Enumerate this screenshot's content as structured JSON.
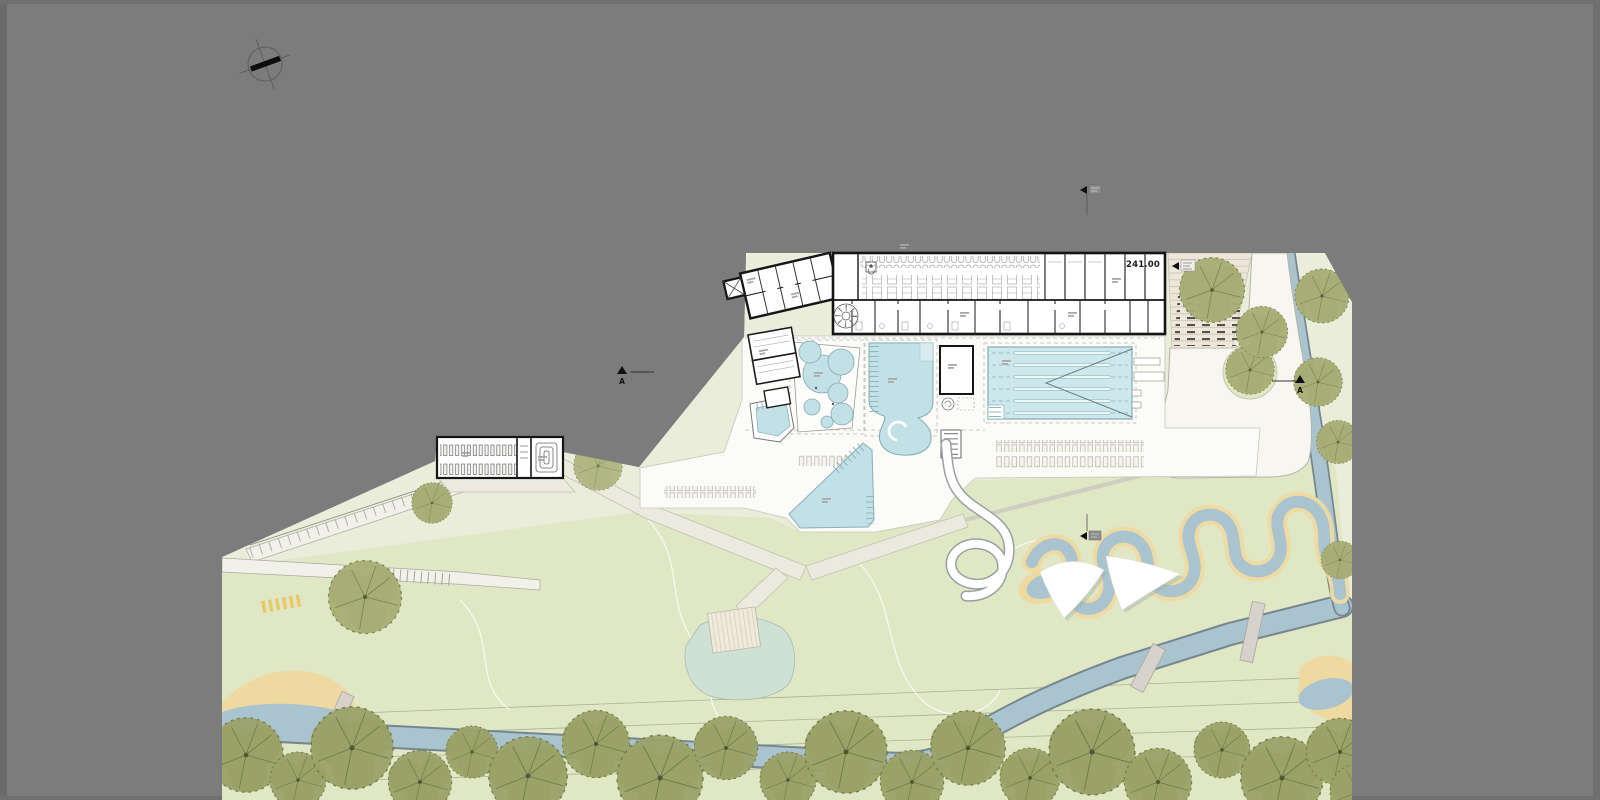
{
  "document": {
    "type": "architectural-site-plan",
    "subject": "Outdoor swimming pool (Freibad) site plan: main bath building floor plan, pools, water slide, sun terraces, bike shelter, spectator steps, meandering play stream, river channel with footbridges, tree rows",
    "background_color": "#7c7c7c"
  },
  "labels": {
    "elevation_mark": "241.00",
    "section_marker_left": "A",
    "section_marker_right": "A"
  },
  "palette": {
    "canvas_gray": "#7c7c7c",
    "site_green": "#e9edd9",
    "lawn_green": "#dfe7c5",
    "pool_blue": "#c2e1e6",
    "lane_pool_blue": "#cde8ec",
    "stream_blue": "#a9c4ce",
    "stream_outline": "#76868f",
    "sand_yellow": "#eed9a1",
    "terrace_white": "#fbfbf7",
    "path_beige": "#eceadf",
    "road_white": "#f7f6f1",
    "wall_black": "#151515",
    "tree_olive": "#a6ad74",
    "tree_row_olive": "#9aa268",
    "steps_beige": "#ece7da",
    "deck_tan": "#eeebdc",
    "bridge_gray": "#d7d3cc",
    "pond_green": "#cfe0d5",
    "crosswalk_yellow": "#e8c86a"
  },
  "features": [
    "north-compass",
    "main-building",
    "changing-cubicle-row",
    "locker-banks",
    "spiral-stair",
    "stair-tower",
    "bike-shelter",
    "spectator-steps",
    "access-road-loop",
    "lap-pool",
    "family-pool",
    "whirlpool-cluster",
    "kids-pool",
    "leisure-pool",
    "water-slide",
    "sun-lounger-rows",
    "pool-terrace",
    "zigzag-ramp",
    "meandering-stream",
    "shade-sails",
    "pond",
    "wooden-deck",
    "river-channel",
    "footbridges",
    "tree-rows",
    "beach-sand",
    "section-markers"
  ]
}
